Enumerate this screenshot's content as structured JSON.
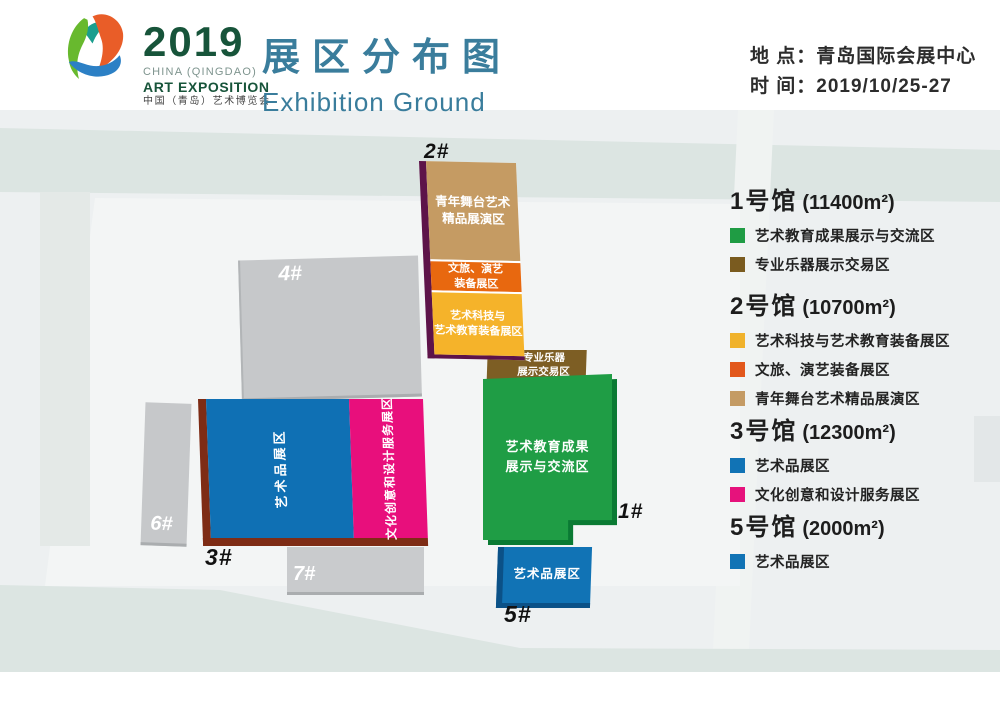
{
  "header": {
    "logo_year": "2019",
    "logo_sub1": "CHINA (QINGDAO)",
    "logo_sub2": "ART EXPOSITION",
    "logo_sub3": "中国（青岛）艺术博览会",
    "title": "展区分布图",
    "subtitle": "Exhibition Ground",
    "location_line": "地 点：青岛国际会展中心",
    "time_line": "时 间：2019/10/25-27",
    "title_color": "#3a7d9c"
  },
  "map": {
    "buildings": {
      "hall2": {
        "label": "2#",
        "edge_color": "#5d1349",
        "sections": [
          {
            "text": "青年舞台艺术\n精品展演区",
            "color": "#c59b63"
          },
          {
            "text": "文旅、演艺\n装备展区",
            "color": "#e8680f"
          },
          {
            "text": "艺术科技与\n艺术教育装备展区",
            "color": "#f5b32a"
          }
        ]
      },
      "instrument_block": {
        "text": "专业乐器\n展示交易区",
        "color": "#7d5e24"
      },
      "hall1": {
        "label": "1#",
        "text": "艺术教育成果\n展示与交流区",
        "color": "#1f9d45",
        "edge_color": "#0a7a33"
      },
      "hall5": {
        "label": "5#",
        "text": "艺术品展区",
        "color": "#1173b5",
        "edge_color": "#0b5187"
      },
      "hall3": {
        "label": "3#",
        "blue_text": "艺术品展区",
        "blue_color": "#0f70b4",
        "pink_text": "文化创意和设计服务展区",
        "pink_color": "#e80f7c",
        "edge_color": "#7e2c15"
      },
      "hall4": {
        "label": "4#"
      },
      "hall6": {
        "label": "6#"
      },
      "hall7": {
        "label": "7#"
      }
    }
  },
  "legend": {
    "halls": [
      {
        "name": "1号馆",
        "area": "(11400m²)",
        "items": [
          {
            "color": "#1f9c44",
            "label": "艺术教育成果展示与交流区"
          },
          {
            "color": "#7a5b1f",
            "label": "专业乐器展示交易区"
          }
        ]
      },
      {
        "name": "2号馆",
        "area": "(10700m²)",
        "items": [
          {
            "color": "#f0b22b",
            "label": "艺术科技与艺术教育装备展区"
          },
          {
            "color": "#e2571b",
            "label": "文旅、演艺装备展区"
          },
          {
            "color": "#c49b64",
            "label": "青年舞台艺术精品展演区"
          }
        ]
      },
      {
        "name": "3号馆",
        "area": "(12300m²)",
        "items": [
          {
            "color": "#1173b5",
            "label": "艺术品展区"
          },
          {
            "color": "#e6127c",
            "label": "文化创意和设计服务展区"
          }
        ]
      },
      {
        "name": "5号馆",
        "area": "(2000m²)",
        "items": [
          {
            "color": "#1173b5",
            "label": "艺术品展区"
          }
        ]
      }
    ]
  }
}
